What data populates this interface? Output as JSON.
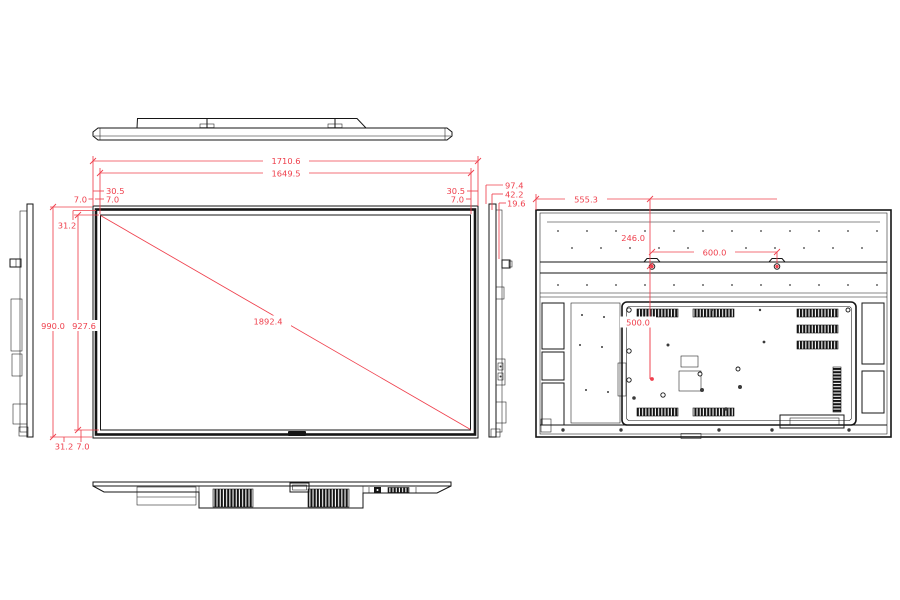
{
  "drawing": {
    "units": "mm",
    "colors": {
      "line": "#161616",
      "dimension": "#ef404d",
      "background": "#ffffff"
    },
    "views": {
      "top": "top-view",
      "front": "front-view",
      "left_side": "left-side-view",
      "right_side": "right-side-view",
      "bottom": "bottom-view",
      "rear": "rear-view"
    },
    "dimensions": {
      "front": {
        "overall_width": "1710.6",
        "active_width": "1649.5",
        "overall_height": "990.0",
        "active_height": "927.6",
        "diagonal": "1892.4",
        "side_bezel_left": "30.5",
        "side_bezel_right": "30.5",
        "top_bezel": "31.2",
        "bottom_bezel": "31.2",
        "top_edge_left_outer": "7.0",
        "top_edge_left": "7.0",
        "top_edge_right": "7.0",
        "bottom_edge": "7.0"
      },
      "side": {
        "overall_depth": "97.4",
        "body_depth": "42.2",
        "panel_depth": "19.6"
      },
      "rear": {
        "mount_center_from_left": "555.3",
        "mount_from_top": "246.0",
        "mount_spacing_horizontal": "600.0",
        "mount_spacing_vertical": "500.0"
      }
    }
  }
}
